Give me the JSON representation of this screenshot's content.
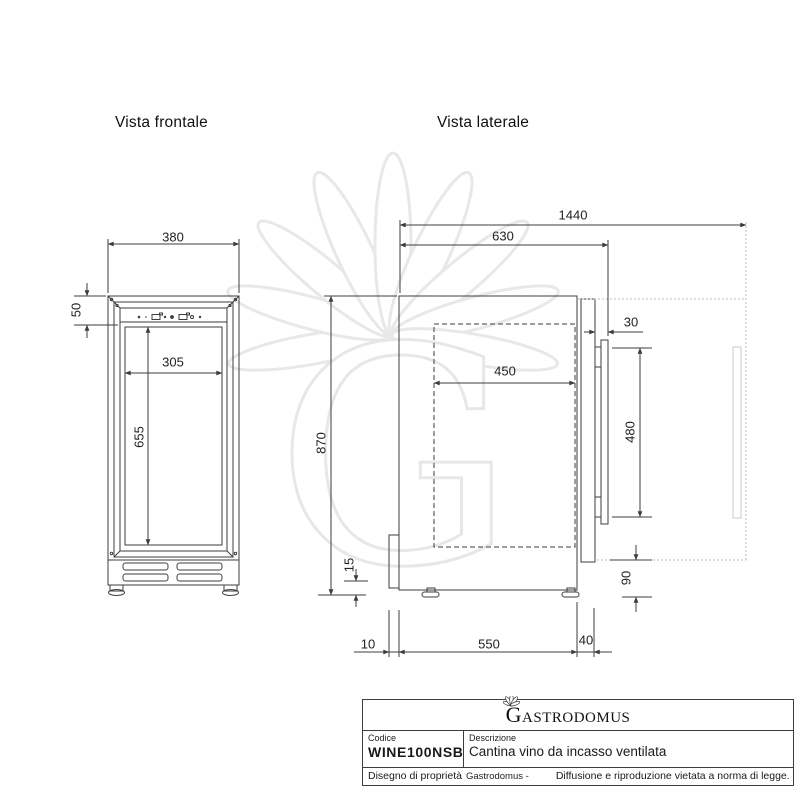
{
  "titles": {
    "front": "Vista frontale",
    "side": "Vista laterale"
  },
  "dims": {
    "fv_width": "380",
    "fv_panel_height": "50",
    "fv_inner_width": "305",
    "fv_inner_height": "655",
    "sv_total_open_depth": "1440",
    "sv_depth_with_handle": "630",
    "sv_height": "870",
    "sv_inner_depth": "450",
    "sv_handle_depth": "30",
    "sv_handle_height": "480",
    "sv_bottom_clearance": "90",
    "sv_foot_height": "15",
    "sv_rear_gap": "10",
    "sv_body_depth": "550",
    "sv_door_depth": "40"
  },
  "title_block": {
    "brand": "Gastrodomus",
    "code_label": "Codice",
    "code_value": "WINE100NSB",
    "description_label": "Descrizione",
    "description_value": "Cantina vino da incasso ventilata",
    "disclaimer_owner": "Disegno di proprietà",
    "disclaimer_brand": "Gastrodomus -",
    "disclaimer_notice": "Diffusione e riproduzione vietata a norma di legge."
  },
  "watermark": {
    "letter": "G"
  },
  "colors": {
    "line": "#3d3d3d",
    "faint": "#b9b9b9",
    "watermark": "#e8e8e8"
  }
}
